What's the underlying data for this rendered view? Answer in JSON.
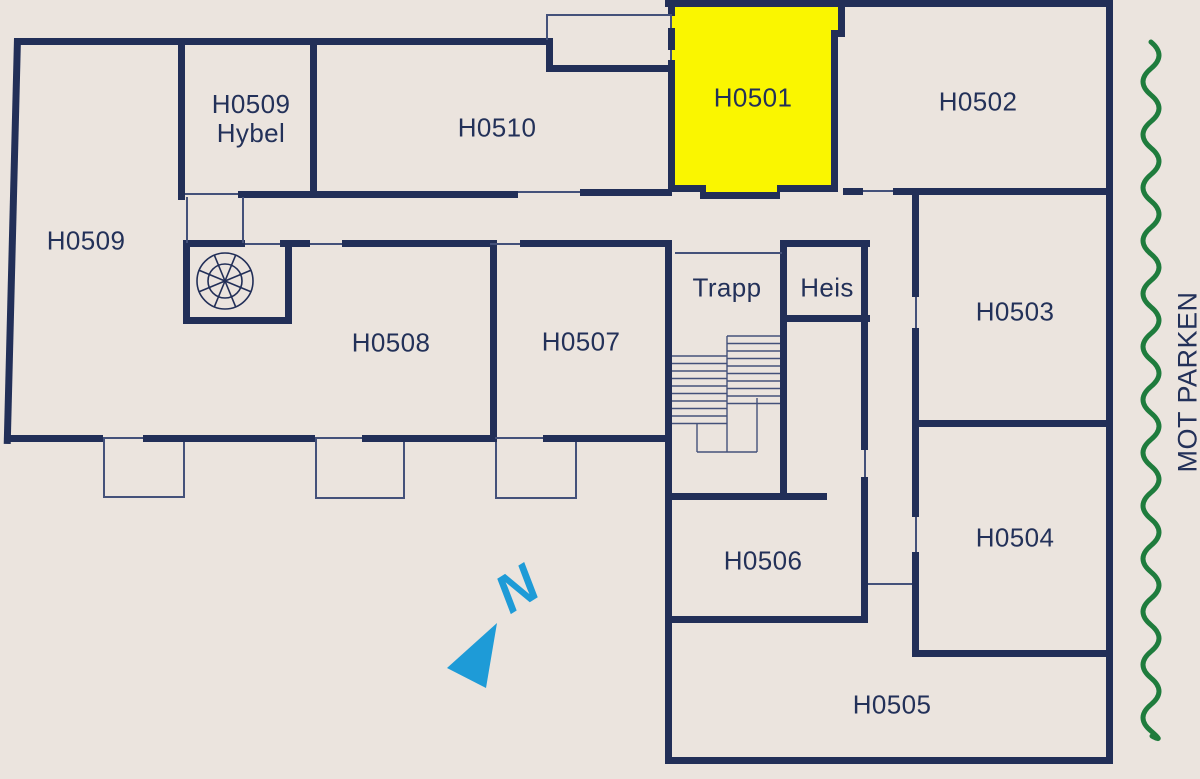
{
  "rooms": [
    {
      "id": "h0509-hybel",
      "line1": "H0509",
      "line2": "Hybel",
      "highlighted": false
    },
    {
      "id": "h0510",
      "label": "H0510",
      "highlighted": false
    },
    {
      "id": "h0501",
      "label": "H0501",
      "highlighted": true
    },
    {
      "id": "h0502",
      "label": "H0502",
      "highlighted": false
    },
    {
      "id": "h0509",
      "label": "H0509",
      "highlighted": false
    },
    {
      "id": "h0508",
      "label": "H0508",
      "highlighted": false
    },
    {
      "id": "h0507",
      "label": "H0507",
      "highlighted": false
    },
    {
      "id": "trapp",
      "label": "Trapp",
      "highlighted": false
    },
    {
      "id": "heis",
      "label": "Heis",
      "highlighted": false
    },
    {
      "id": "h0503",
      "label": "H0503",
      "highlighted": false
    },
    {
      "id": "h0504",
      "label": "H0504",
      "highlighted": false
    },
    {
      "id": "h0506",
      "label": "H0506",
      "highlighted": false
    },
    {
      "id": "h0505",
      "label": "H0505",
      "highlighted": false
    }
  ],
  "annotations": {
    "park_label": "MOT PARKEN",
    "north_label": "N"
  },
  "colors": {
    "background": "#EBE4DE",
    "wall": "#222F58",
    "highlight": "#FAF600",
    "compass_blue": "#1E9BD7",
    "park_green": "#1F7C3D",
    "label_text": "#233159"
  }
}
